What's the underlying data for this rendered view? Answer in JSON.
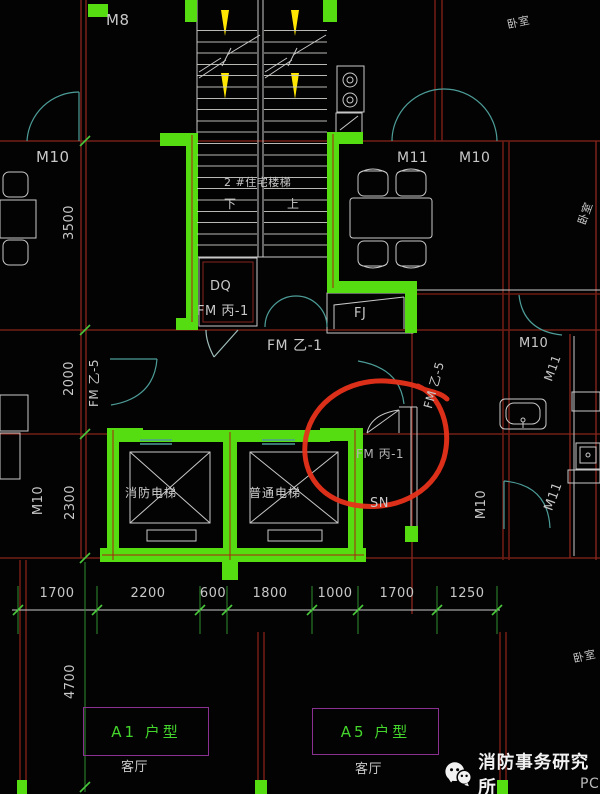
{
  "colors": {
    "background": "#030303",
    "wall_green": "#55dd11",
    "axis_red": "#8a261c",
    "wall_dark_red": "#6e1b13",
    "line_white": "#c8c8c8",
    "door_cyan": "#4d9d98",
    "arrow_yellow": "#ffe600",
    "unit_box_purple": "#8a3090",
    "unit_text_green": "#44d62c",
    "tick_green": "#49c83c",
    "marker_red": "#e8311a",
    "watermark_white": "#f2f2f2"
  },
  "labels": {
    "m8": "M8",
    "stair_name": "2 #住宅楼梯",
    "stair_down": "下",
    "stair_up": "上",
    "m10_top_left": "M10",
    "bedroom_top_right": "卧室",
    "m11_dining": "M11",
    "m10_entry": "M10",
    "bedroom_right": "卧室",
    "dq": "DQ",
    "fm_bing1_upper": "FM 丙-1",
    "fj": "FJ",
    "fm_yi1": "FM 乙-1",
    "fm_yi5_left": "FM 乙-5",
    "fm_yi5_right": "FM 乙-5",
    "m10_left_mid": "M10",
    "fire_elevator": "消防电梯",
    "common_elevator": "普通电梯",
    "fm_bing1_circled": "FM 丙-1",
    "sn": "SN",
    "m10_bath": "M10",
    "m11_bath": "M11",
    "m10_corridor": "M10",
    "m11_corridor": "M11",
    "unit_a1": "A1 户型",
    "unit_a5": "A5 户型",
    "living_a1": "客厅",
    "living_a5": "客厅",
    "bedroom_bottom_right": "卧室",
    "pc_partial": "PC"
  },
  "dimensions": {
    "horizontal_row": [
      "1700",
      "2200",
      "600",
      "1800",
      "1000",
      "1700",
      "1250"
    ],
    "left_3500": "3500",
    "left_2000": "2000",
    "left_2300": "2300",
    "left_4700": "4700"
  },
  "watermark": {
    "text": "消防事务研究所",
    "icon": "wechat-icon"
  }
}
